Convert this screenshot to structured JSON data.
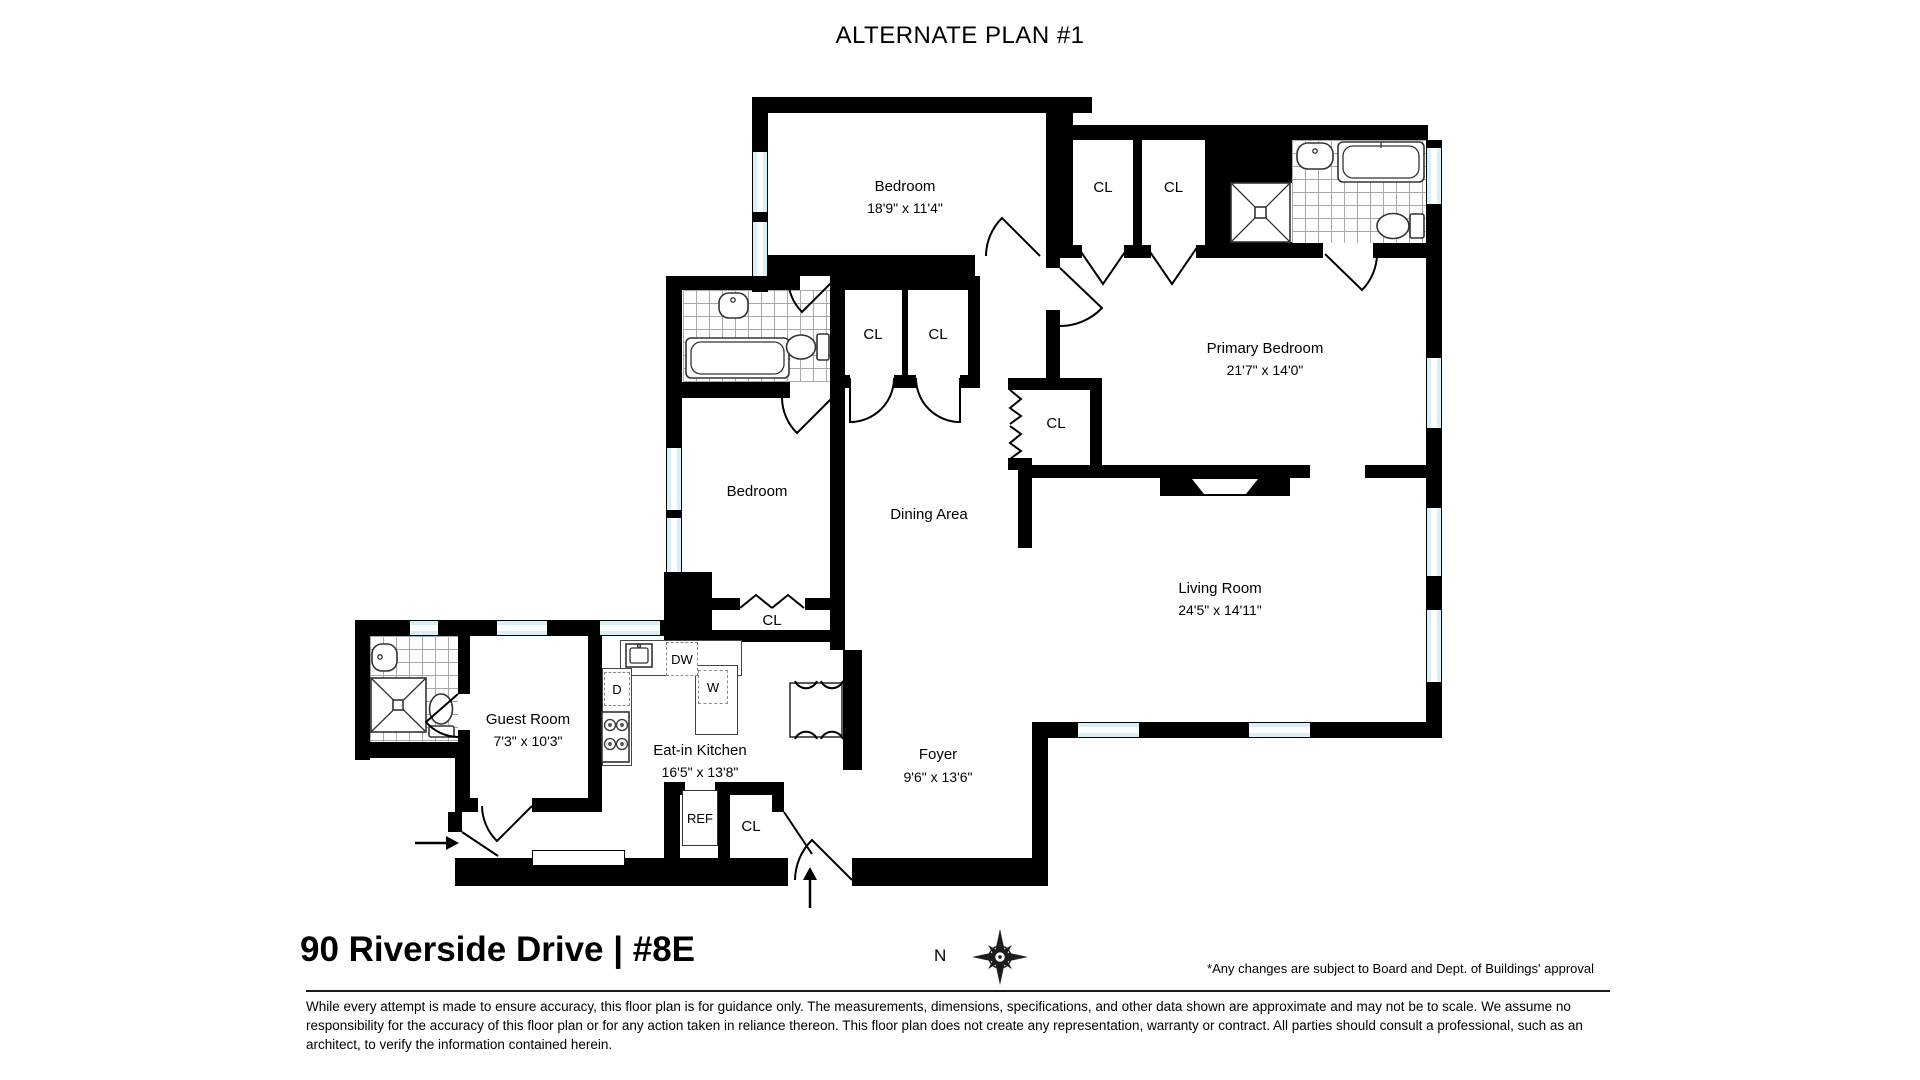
{
  "title": "ALTERNATE PLAN #1",
  "rooms": {
    "bedroom_top": {
      "name": "Bedroom",
      "dims": "18'9\" x 11'4\""
    },
    "primary_bedroom": {
      "name": "Primary Bedroom",
      "dims": "21'7\" x 14'0\""
    },
    "bedroom_mid": {
      "name": "Bedroom"
    },
    "dining_area": {
      "name": "Dining Area"
    },
    "living_room": {
      "name": "Living Room",
      "dims": "24'5\" x 14'11\""
    },
    "guest_room": {
      "name": "Guest Room",
      "dims": "7'3\" x 10'3\""
    },
    "kitchen": {
      "name": "Eat-in Kitchen",
      "dims": "16'5\" x 13'8\""
    },
    "foyer": {
      "name": "Foyer",
      "dims": "9'6\" x 13'6\""
    }
  },
  "labels": {
    "closet": "CL",
    "dishwasher": "DW",
    "dryer": "D",
    "washer": "W",
    "refrigerator": "REF",
    "north": "N"
  },
  "footer": {
    "address": "90 Riverside Drive | #8E",
    "approval_note": "*Any changes are subject to Board and Dept. of Buildings' approval",
    "disclaimer": "While every attempt is made to ensure accuracy, this floor plan is for guidance only. The measurements, dimensions, specifications, and other data shown are approximate and may not be to scale. We assume no responsibility for the accuracy of this floor plan or for any action taken in reliance thereon. This floor plan does not create any representation, warranty or contract. All parties should consult a professional, such as an architect, to verify the information contained herein."
  },
  "colors": {
    "wall": "#000000",
    "window": "#d7f0f6",
    "tile_line": "#a8a8a8"
  }
}
